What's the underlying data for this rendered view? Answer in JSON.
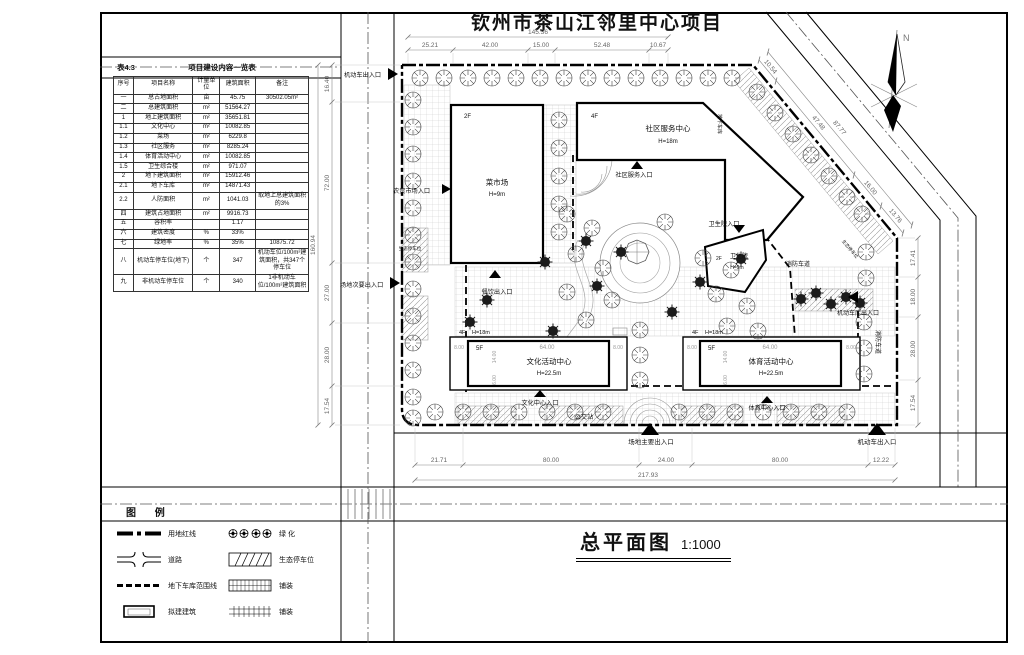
{
  "title": "钦州市茶山江邻里中心项目",
  "north": "N",
  "drawing": {
    "name": "总平面图",
    "scale": "1:1000"
  },
  "table": {
    "caption": "表4.3",
    "title": "项目建设内容一览表",
    "headers": [
      "序号",
      "项目名称",
      "计量单位",
      "建筑面积",
      "备注"
    ],
    "rows": [
      [
        "一",
        "总占地面积",
        "亩",
        "45.75",
        "30502.05m²"
      ],
      [
        "二",
        "总建筑面积",
        "m²",
        "51564.27",
        ""
      ],
      [
        "1",
        "地上建筑面积",
        "m²",
        "35651.81",
        ""
      ],
      [
        "1.1",
        "文化中心",
        "m²",
        "10082.85",
        ""
      ],
      [
        "1.2",
        "菜场",
        "m²",
        "6229.8",
        ""
      ],
      [
        "1.3",
        "社区服务",
        "m²",
        "8285.24",
        ""
      ],
      [
        "1.4",
        "体育活动中心",
        "m²",
        "10082.85",
        ""
      ],
      [
        "1.5",
        "卫生综合楼",
        "m²",
        "971.07",
        ""
      ],
      [
        "2",
        "地下建筑面积",
        "m²",
        "15912.46",
        ""
      ],
      [
        "2.1",
        "地下车库",
        "m²",
        "14871.43",
        ""
      ],
      [
        "2.2",
        "人防面积",
        "m²",
        "1041.03",
        "取地上总建筑面积的3%"
      ],
      [
        "四",
        "建筑占地面积",
        "m²",
        "9916.73",
        ""
      ],
      [
        "五",
        "容积率",
        "",
        "1.17",
        ""
      ],
      [
        "六",
        "建筑密度",
        "%",
        "33%",
        ""
      ],
      [
        "七",
        "绿地率",
        "%",
        "35%",
        "10875.72"
      ],
      [
        "八",
        "机动车停车位(地下)",
        "个",
        "347",
        "机动车位/100m²建筑面积，共347个停车位"
      ],
      [
        "九",
        "非机动车停车位",
        "个",
        "340",
        "1非机动车位/100m²建筑面积"
      ]
    ]
  },
  "legend": {
    "title": "图 例",
    "items": [
      {
        "label": "用地红线"
      },
      {
        "label": "道路"
      },
      {
        "label": "地下车库范围线"
      },
      {
        "label": "拟建建筑"
      },
      {
        "label": "绿 化"
      },
      {
        "label": "生态停车位"
      },
      {
        "label": "铺装"
      },
      {
        "label": "铺装"
      }
    ]
  },
  "buildings": {
    "market": {
      "floors": "2F",
      "name": "菜市场",
      "height": "H=9m"
    },
    "community": {
      "floors": "4F",
      "name": "社区服务中心",
      "height": "H=18m"
    },
    "clinic": {
      "floors": "2F",
      "name": "卫生院",
      "height": "H=9m"
    },
    "culture": {
      "wing": "4F",
      "wing_h": "H=18m",
      "floors": "5F",
      "name": "文化活动中心",
      "height": "H=22.5m",
      "len": "64.00",
      "side_l": "8.00",
      "side_r": "8.00",
      "d1": "14.00",
      "d2": "6.00"
    },
    "sports": {
      "wing": "4F",
      "wing_h": "H=18m",
      "floors": "5F",
      "name": "体育活动中心",
      "height": "H=22.5m",
      "len": "64.00",
      "side_l": "8.00",
      "side_r": "8.00",
      "d1": "14.00",
      "d2": "6.00"
    }
  },
  "labels": {
    "entry_motor_nw": "机动车出入口",
    "entry_market": "农贸市场入口",
    "entry_secondary": "场地次要出入口",
    "entry_dining": "餐饮出入口",
    "entry_community": "社区服务入口",
    "entry_clinic": "卫生院入口",
    "entry_garage": "机动车库出入口",
    "entry_culture": "文化中心入口",
    "bus_stop": "公交站",
    "entry_sports": "体育中心入口",
    "entry_main": "场地主要出入口",
    "entry_motor_se": "机动车出入口",
    "fire_lane_e": "消防车道",
    "fire_lane_n": "消防车道",
    "eco_parking_w": "生态停车位",
    "eco_parking_e": "生态停车位",
    "garage_ramp": "地下车库"
  },
  "dims": {
    "top_total": "145.36",
    "top": [
      "25.21",
      "42.00",
      "15.00",
      "52.48",
      "10.67"
    ],
    "left_total": "160.94",
    "left": [
      "16.40",
      "72.00",
      "27.00",
      "28.00",
      "17.54"
    ],
    "right": [
      "17.41",
      "18.00",
      "28.00",
      "17.54"
    ],
    "bottom": [
      "21.71",
      "80.00",
      "24.00",
      "80.00",
      "12.22"
    ],
    "bottom_total": "217.93",
    "ne": [
      "10.54",
      "47.48",
      "16.00",
      "13.76"
    ],
    "ne_total": "87.77"
  }
}
